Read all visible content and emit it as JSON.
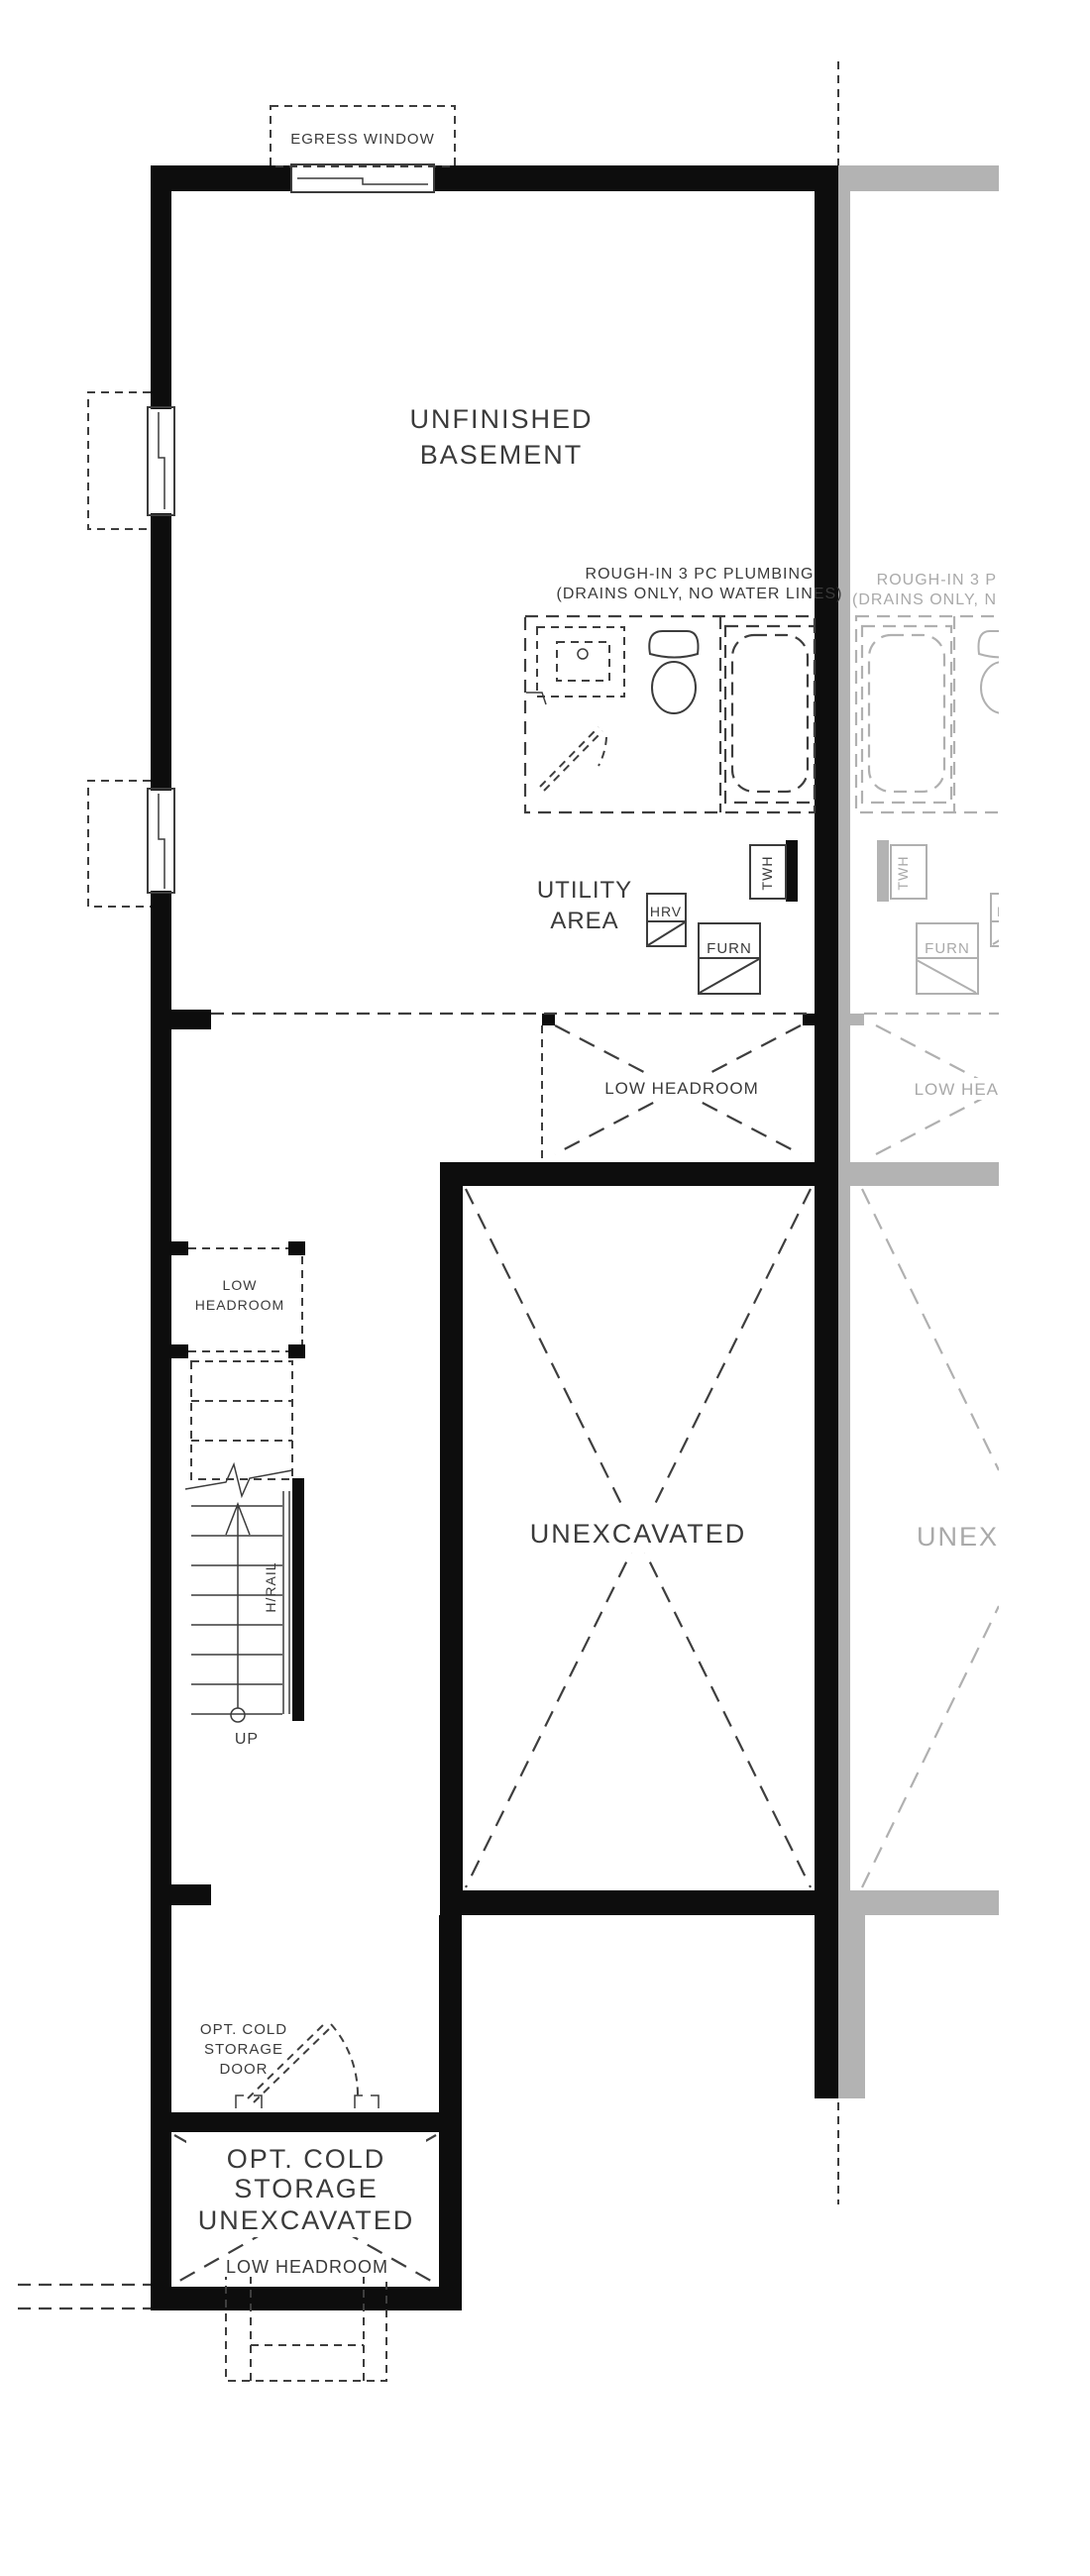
{
  "colors": {
    "background": "#ffffff",
    "wall": "#0d0d0d",
    "line": "#3c3c3c",
    "text": "#3a3a3a",
    "adjacent_wall": "#b3b3b3",
    "adjacent_line": "#b0b0b0",
    "adjacent_text": "#a9a9a9"
  },
  "main_unit": {
    "egress_window": "EGRESS WINDOW",
    "room_line1": "UNFINISHED",
    "room_line2": "BASEMENT",
    "plumbing_line1": "ROUGH-IN 3 PC PLUMBING",
    "plumbing_line2": "(DRAINS ONLY, NO WATER LINES)",
    "utility_line1": "UTILITY",
    "utility_line2": "AREA",
    "hrv": "HRV",
    "twh": "TWH",
    "furn": "FURN",
    "low_headroom": "LOW HEADROOM",
    "stair_low_line1": "LOW",
    "stair_low_line2": "HEADROOM",
    "hrail": "H/RAIL",
    "up": "UP",
    "unexcavated": "UNEXCAVATED",
    "door_line1": "OPT. COLD",
    "door_line2": "STORAGE",
    "door_line3": "DOOR",
    "cold_line1": "OPT. COLD",
    "cold_line2": "STORAGE",
    "cold_line3": "UNEXCAVATED",
    "cold_low_headroom": "LOW HEADROOM"
  },
  "adjacent_unit": {
    "plumbing_line1": "ROUGH-IN 3 P",
    "plumbing_line2": "(DRAINS ONLY, N",
    "twh": "TWH",
    "furn": "FURN",
    "hrv": "HRV",
    "low_headroom": "LOW HEA",
    "unexcavated": "UNEX"
  }
}
